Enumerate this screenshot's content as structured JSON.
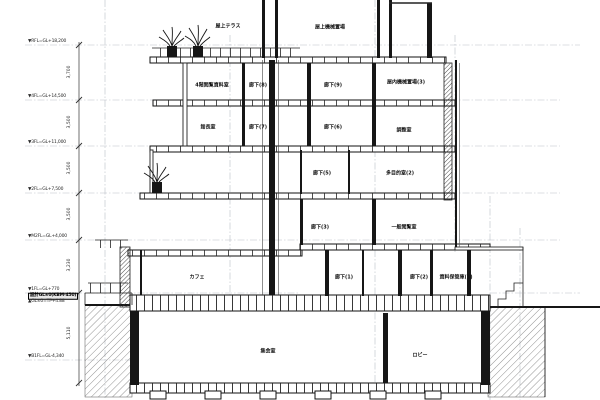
{
  "colors": {
    "paper": "#ffffff",
    "line": "#161616",
    "grid": "#b9bfc7",
    "hatch": "#777777"
  },
  "labels": {
    "rooms": [
      {
        "text": "屋上テラス",
        "x": 228,
        "y": 27
      },
      {
        "text": "屋上機械置場",
        "x": 330,
        "y": 28
      },
      {
        "text": "4階閲覧資料室",
        "x": 212,
        "y": 86
      },
      {
        "text": "廊下(8)",
        "x": 258,
        "y": 86
      },
      {
        "text": "廊下(9)",
        "x": 333,
        "y": 86
      },
      {
        "text": "屋内機械置場(3)",
        "x": 406,
        "y": 83
      },
      {
        "text": "館長室",
        "x": 208,
        "y": 128
      },
      {
        "text": "廊下(7)",
        "x": 258,
        "y": 128
      },
      {
        "text": "廊下(6)",
        "x": 333,
        "y": 128
      },
      {
        "text": "調整室",
        "x": 404,
        "y": 131
      },
      {
        "text": "廊下(5)",
        "x": 322,
        "y": 174
      },
      {
        "text": "多目的室(2)",
        "x": 400,
        "y": 174
      },
      {
        "text": "廊下(3)",
        "x": 320,
        "y": 228
      },
      {
        "text": "一般閲覧室",
        "x": 404,
        "y": 228
      },
      {
        "text": "カフェ",
        "x": 197,
        "y": 278
      },
      {
        "text": "廊下(1)",
        "x": 344,
        "y": 278
      },
      {
        "text": "廊下(2)",
        "x": 419,
        "y": 278
      },
      {
        "text": "資料保管庫(1)",
        "x": 456,
        "y": 278
      },
      {
        "text": "集会室",
        "x": 268,
        "y": 352
      },
      {
        "text": "ロビー",
        "x": 420,
        "y": 356
      }
    ],
    "levels": [
      {
        "text": "▼RFL=GL+18,200",
        "x": 28,
        "y": 42
      },
      {
        "text": "▼4FL=GL+14,500",
        "x": 28,
        "y": 97
      },
      {
        "text": "▼3FL=GL+11,000",
        "x": 28,
        "y": 143
      },
      {
        "text": "▼2FL=GL+7,500",
        "x": 28,
        "y": 190
      },
      {
        "text": "▼M2FL=GL+4,000",
        "x": 28,
        "y": 237
      },
      {
        "text": "▼1FL=GL+770",
        "x": 28,
        "y": 290
      },
      {
        "text": "設計GL±0(KBM-450)",
        "x": 28,
        "y": 296,
        "emph": true
      },
      {
        "text": "▲GL±0=TP+4.88",
        "x": 28,
        "y": 302
      },
      {
        "text": "▼B1FL=GL-4,340",
        "x": 28,
        "y": 357
      }
    ],
    "dims": [
      {
        "text": "3,700",
        "x": 70,
        "y": 72
      },
      {
        "text": "3,500",
        "x": 70,
        "y": 122
      },
      {
        "text": "3,500",
        "x": 70,
        "y": 168
      },
      {
        "text": "3,500",
        "x": 70,
        "y": 214
      },
      {
        "text": "3,230",
        "x": 70,
        "y": 265
      },
      {
        "text": "5,110",
        "x": 70,
        "y": 333
      }
    ]
  }
}
